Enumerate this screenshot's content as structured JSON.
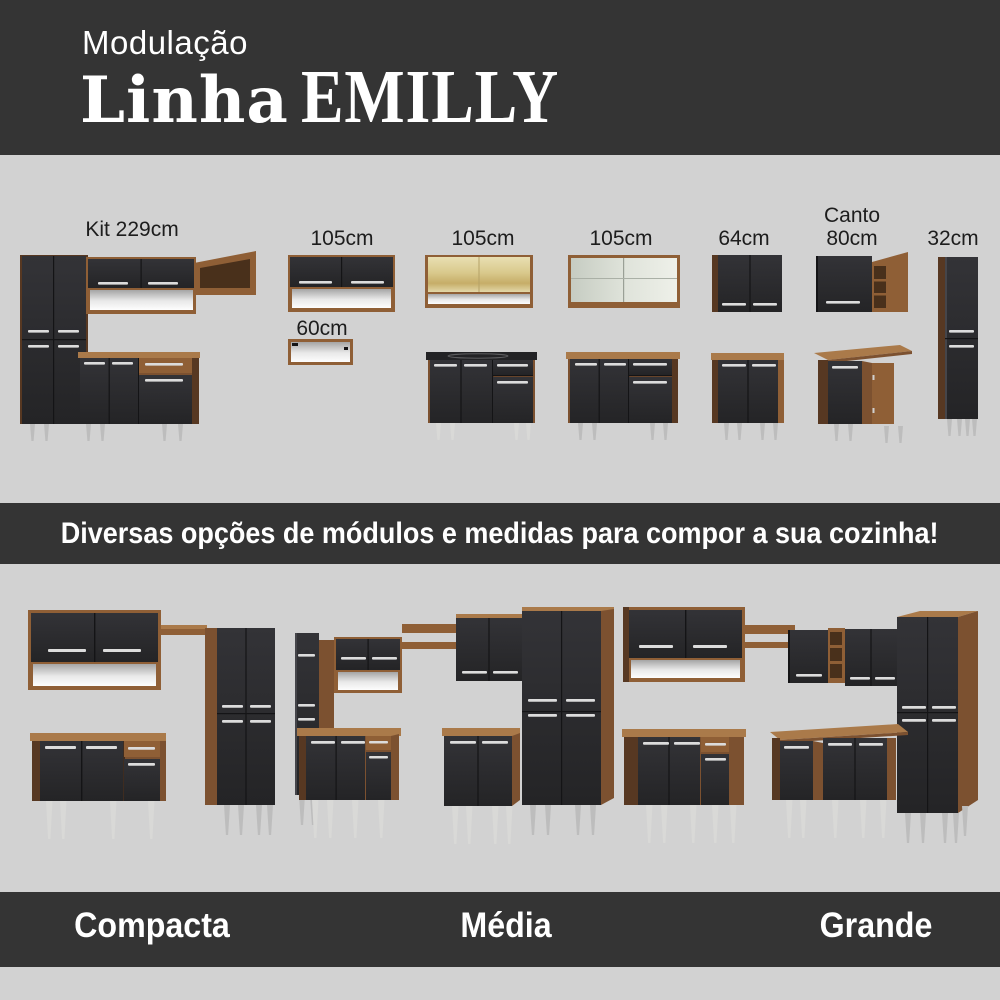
{
  "header": {
    "kicker": "Modulação",
    "title_script": "Linha",
    "title_brand": "EMILLY"
  },
  "modules": {
    "kit229": {
      "label": "Kit 229cm"
    },
    "wall105": {
      "label": "105cm"
    },
    "shelf60": {
      "label": "60cm"
    },
    "glass105": {
      "label": "105cm"
    },
    "slide105": {
      "label": "105cm"
    },
    "wall64": {
      "label": "64cm"
    },
    "canto80": {
      "line1": "Canto",
      "line2": "80cm"
    },
    "tall32": {
      "label": "32cm"
    }
  },
  "banner": {
    "text": "Diversas opções de módulos e medidas para compor a sua cozinha!"
  },
  "kits": [
    {
      "label": "Compacta"
    },
    {
      "label": "Média"
    },
    {
      "label": "Grande"
    }
  ],
  "palette": {
    "band": "#343434",
    "background": "#d2d2d2",
    "door_black": "#2b2b2d",
    "wood": "#8f5f36",
    "wood_light": "#aa7a4a",
    "wood_dark": "#573822",
    "handle_silver": "#dcdcdc",
    "leg_silver": "#bdbdbd",
    "text_dark": "#1d1d1d",
    "text_light": "#ffffff"
  }
}
